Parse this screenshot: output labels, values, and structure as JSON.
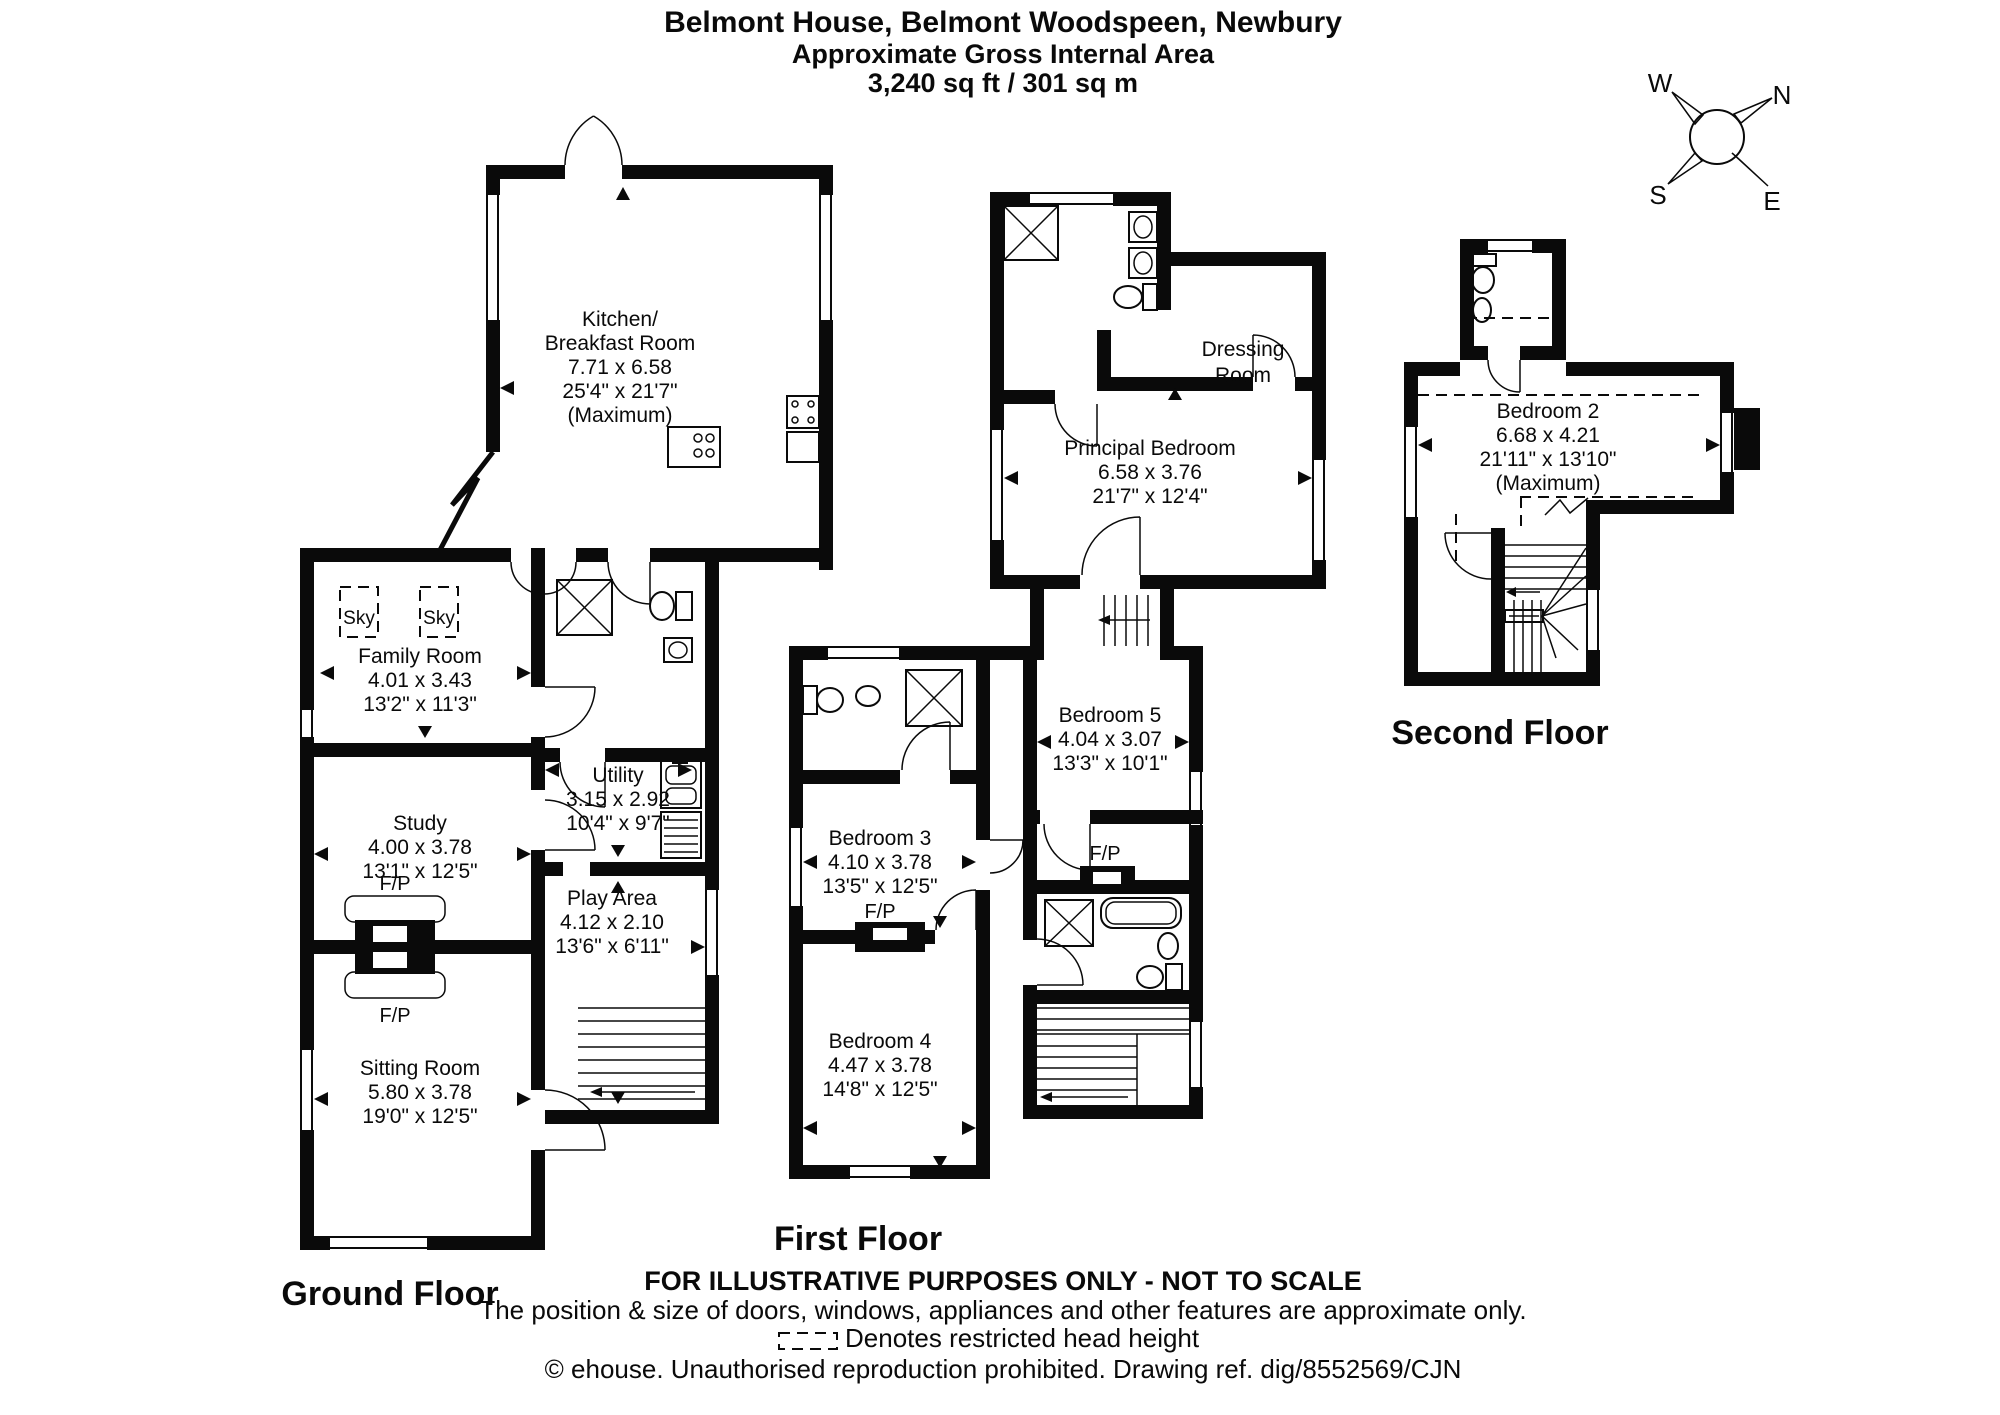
{
  "header": {
    "title": "Belmont House, Belmont Woodspeen, Newbury",
    "subtitle": "Approximate Gross Internal Area",
    "area": "3,240 sq ft / 301 sq m"
  },
  "compass": {
    "north": "N",
    "east": "E",
    "south": "S",
    "west": "W"
  },
  "floors": {
    "ground": {
      "label": "Ground Floor",
      "rooms": {
        "kitchen": {
          "name": "Kitchen/",
          "name2": "Breakfast Room",
          "metric": "7.71 x 6.58",
          "imperial": "25'4\" x 21'7\"",
          "note": "(Maximum)"
        },
        "family": {
          "name": "Family Room",
          "metric": "4.01 x 3.43",
          "imperial": "13'2\" x 11'3\""
        },
        "study": {
          "name": "Study",
          "metric": "4.00 x 3.78",
          "imperial": "13'1\" x 12'5\""
        },
        "sitting": {
          "name": "Sitting Room",
          "metric": "5.80 x 3.78",
          "imperial": "19'0\" x 12'5\""
        },
        "utility": {
          "name": "Utility",
          "metric": "3.15 x 2.92",
          "imperial": "10'4\" x 9'7\""
        },
        "play": {
          "name": "Play Area",
          "metric": "4.12 x 2.10",
          "imperial": "13'6\" x 6'11\""
        }
      },
      "annotations": {
        "sky": "Sky",
        "fireplace": "F/P"
      }
    },
    "first": {
      "label": "First Floor",
      "rooms": {
        "principal": {
          "name": "Principal Bedroom",
          "metric": "6.58 x 3.76",
          "imperial": "21'7\" x 12'4\""
        },
        "dressing": {
          "name": "Dressing",
          "name2": "Room"
        },
        "bedroom5": {
          "name": "Bedroom 5",
          "metric": "4.04 x 3.07",
          "imperial": "13'3\" x 10'1\""
        },
        "bedroom3": {
          "name": "Bedroom 3",
          "metric": "4.10 x 3.78",
          "imperial": "13'5\" x 12'5\""
        },
        "bedroom4": {
          "name": "Bedroom 4",
          "metric": "4.47 x 3.78",
          "imperial": "14'8\" x 12'5\""
        }
      },
      "annotations": {
        "fireplace": "F/P"
      }
    },
    "second": {
      "label": "Second Floor",
      "rooms": {
        "bedroom2": {
          "name": "Bedroom 2",
          "metric": "6.68 x 4.21",
          "imperial": "21'11\" x 13'10\"",
          "note": "(Maximum)"
        }
      }
    }
  },
  "footer": {
    "line1": "FOR ILLUSTRATIVE PURPOSES ONLY - NOT TO SCALE",
    "line2": "The position & size of doors, windows, appliances and other features are approximate only.",
    "restricted": "Denotes restricted head height",
    "copyright": "© ehouse. Unauthorised reproduction prohibited. Drawing ref. dig/8552569/CJN"
  }
}
